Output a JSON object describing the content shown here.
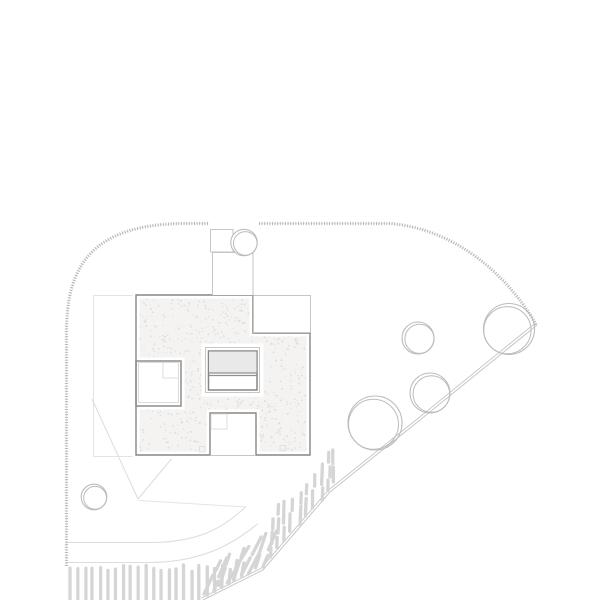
{
  "canvas": {
    "width": 600,
    "height": 600,
    "background": "#ffffff"
  },
  "palette": {
    "stitch": "#b0b0b0",
    "outline_dark": "#868686",
    "line_medium": "#c6c6c6",
    "line_faint": "#dcdcdc",
    "line_xfaint": "#e4e4e4",
    "stipple_dot": "#d6d6d6",
    "roof_base": "#f4f3f1",
    "hatch": "#d5d5d5",
    "tree": "#bcbcbc",
    "stair_fill": "#e9e9e9",
    "stair_dark": "#909090",
    "white": "#ffffff"
  },
  "boundary": {
    "segments": [
      "M66.5,566 L66.5,332 C66.5,268 90,223.5 186,223.5 L209,223.5",
      "M259,223.5 L390,223.5 C452,228.5 505,271 536.5,325"
    ],
    "dash": "0.9 1.7",
    "width": 3.2
  },
  "retaining_edge": {
    "points": [
      [
        203,
        600
      ],
      [
        263,
        570
      ],
      [
        330,
        492
      ],
      [
        420,
        420
      ],
      [
        537,
        325
      ]
    ],
    "offset": [
      -1.7,
      -1.9
    ]
  },
  "walkway": {
    "paths": [
      "M66.5,542.5 L150,542.5 C196,542.5 222,529.5 246,506.5",
      "M66.5,562.5 L148,562.5 C197,562.5 229,547.5 258,523.5",
      "M139,500.5 L246,507"
    ]
  },
  "terrace_lines": {
    "path": "M92,399 L138,499 L173,457"
  },
  "lower_floor_outline": {
    "x": 93.5,
    "y": 295.5,
    "w": 42.5,
    "h": 161
  },
  "building": {
    "roof_path": "M136,295 L253,295 L253,333 L310,333 L310,455 L256,455 L256,413 L210,413 L210,455 L136,455 Z",
    "holes": [
      "M136,361 L181,361 L181,406 L136,406 Z",
      "M205,347 L260,347 L260,393 L205,393 Z"
    ],
    "courtyard_wall_rect": {
      "x": 136,
      "y": 361,
      "w": 45,
      "h": 45
    },
    "patio_open_line": [
      [
        210,
        455.5
      ],
      [
        256,
        455.5
      ]
    ],
    "notch_rect": {
      "x": 253.5,
      "y": 295.5,
      "w": 57,
      "h": 37
    },
    "stair": {
      "outer": {
        "x": 205.5,
        "y": 347.5,
        "w": 54,
        "h": 45
      },
      "inner": {
        "x": 208.5,
        "y": 351,
        "w": 48.5,
        "h": 39
      },
      "landing": {
        "x": 209,
        "y": 351.5,
        "w": 47.5,
        "h": 21
      },
      "divider_y": [
        373,
        375.5
      ]
    },
    "courtyard_detail": [
      {
        "x": 138.5,
        "y": 362.5,
        "w": 40,
        "h": 40
      },
      {
        "x": 163,
        "y": 362.5,
        "w": 15.5,
        "h": 15.5
      }
    ],
    "patio_detail": [
      {
        "x": 211,
        "y": 414,
        "w": 16,
        "h": 15
      }
    ],
    "tiny_marks": [
      {
        "x": 199.5,
        "y": 446.5,
        "w": 5.5,
        "h": 5.5
      },
      {
        "x": 280,
        "y": 445.5,
        "w": 5.5,
        "h": 5.5
      }
    ],
    "stipple": {
      "count": 950,
      "seed": 7,
      "rmin": 0.4,
      "rmax": 0.95,
      "bx": 136,
      "by": 295,
      "bw": 175,
      "bh": 161
    }
  },
  "entry": {
    "planter": {
      "x": 210.5,
      "y": 229.5,
      "w": 22.5,
      "h": 22.5
    },
    "shaft_rect": {
      "x": 212.5,
      "y": 252,
      "w": 40.5,
      "h": 43
    },
    "shaft_path": "M212.5,294.5 L212.5,252.5 L253,252.5 L253,294.5",
    "tree": {
      "cx": 244,
      "cy": 242.5,
      "r": 13.2,
      "r2": 11.8,
      "dx": 1.3,
      "dy": 0.9
    }
  },
  "trees": [
    {
      "cx": 418,
      "cy": 338,
      "r": 16,
      "r2": 14.6,
      "dx": 1.5,
      "dy": 0.8
    },
    {
      "cx": 509,
      "cy": 329,
      "r": 25.5,
      "r2": 23.6,
      "dx": -1.6,
      "dy": 1.2
    },
    {
      "cx": 430,
      "cy": 393,
      "r": 20,
      "r2": 18.3,
      "dx": 1.4,
      "dy": 1.0
    },
    {
      "cx": 375,
      "cy": 423,
      "r": 27,
      "r2": 25.0,
      "dx": -1.5,
      "dy": 1.3
    },
    {
      "cx": 94,
      "cy": 497,
      "r": 12.8,
      "r2": 11.4,
      "dx": 1.1,
      "dy": 0.8
    }
  ],
  "hatch": {
    "seed": 11,
    "stroke_width": 3.3,
    "bottom": {
      "x0": 70,
      "x1": 250,
      "step": 7.6,
      "top": 564.5
    },
    "slope": {
      "x0": 205,
      "x1": 336,
      "step": 7.2
    }
  }
}
